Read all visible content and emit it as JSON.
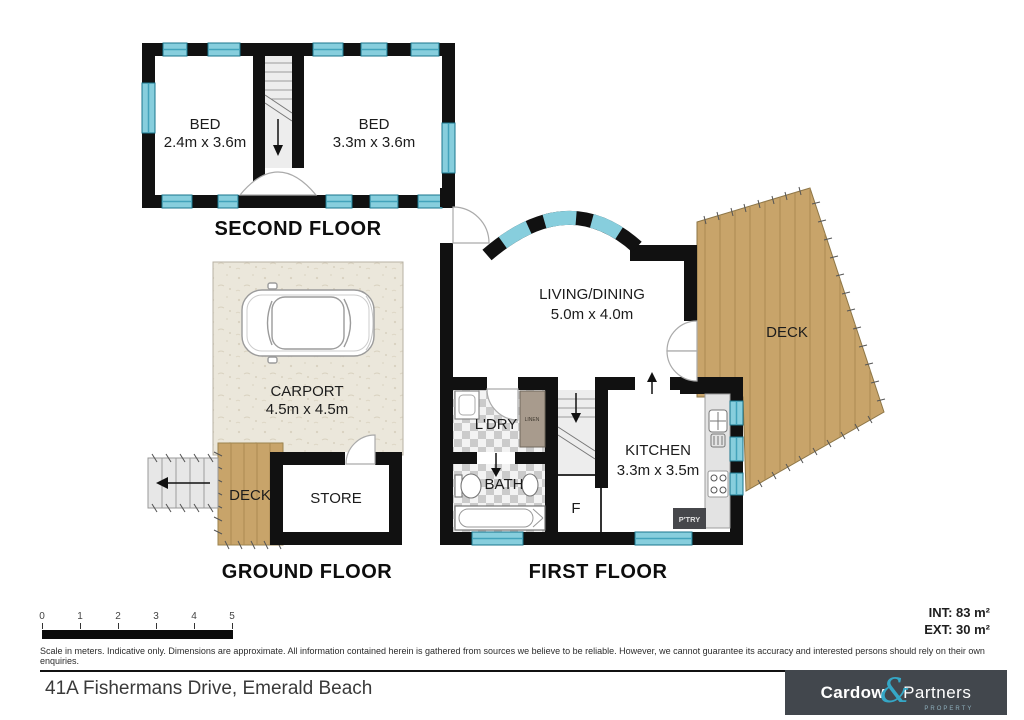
{
  "floors": {
    "second": {
      "label": "SECOND FLOOR",
      "bed1_name": "BED",
      "bed1_dims": "2.4m x 3.6m",
      "bed2_name": "BED",
      "bed2_dims": "3.3m x 3.6m"
    },
    "ground": {
      "label": "GROUND FLOOR",
      "carport_name": "CARPORT",
      "carport_dims": "4.5m x 4.5m",
      "deck_name": "DECK",
      "store_name": "STORE"
    },
    "first": {
      "label": "FIRST FLOOR",
      "living_name": "LIVING/DINING",
      "living_dims": "5.0m x 4.0m",
      "deck_name": "DECK",
      "ldry_name": "L'DRY",
      "linen_name": "LINEN",
      "bath_name": "BATH",
      "kitchen_name": "KITCHEN",
      "kitchen_dims": "3.3m x 3.5m",
      "f_name": "F",
      "pantry_name": "P'TRY"
    }
  },
  "scalebar": {
    "ticks": [
      "0",
      "1",
      "2",
      "3",
      "4",
      "5"
    ]
  },
  "areas": {
    "int_label": "INT: 83 m²",
    "ext_label": "EXT: 30 m²"
  },
  "disclaimer": "Scale in meters. Indicative only. Dimensions are approximate. All information contained herein is gathered from sources we believe to be reliable. However, we cannot guarantee its accuracy and interested persons should rely on their own enquiries.",
  "address": "41A Fishermans Drive, Emerald Beach",
  "logo": {
    "word1": "Cardow",
    "ampersand": "&",
    "word2": "Partners",
    "tagline": "PROPERTY"
  },
  "colors": {
    "wall": "#111111",
    "window": "#87cedd",
    "window_border": "#19768d",
    "deck_wood": "#c8a46a",
    "carport_floor": "#ebe7db",
    "logo_background": "#42474d",
    "logo_teal": "#35a7c6"
  }
}
